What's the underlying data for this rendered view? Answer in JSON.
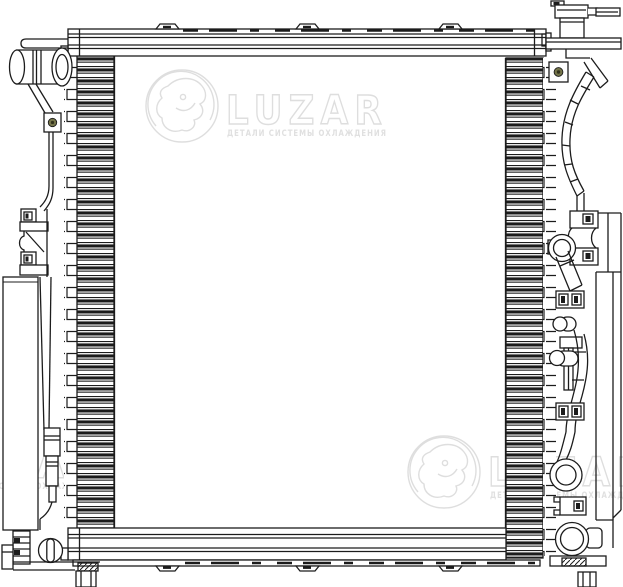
{
  "diagram": {
    "type": "technical-line-drawing",
    "subject": "automotive-radiator-front-view"
  },
  "watermark": {
    "brand": "LUZAR",
    "tagline": "ДЕТАЛИ СИСТЕМЫ ОХЛАЖДЕНИЯ",
    "instances": [
      "top-center",
      "bottom-left-partial",
      "bottom-right"
    ]
  },
  "colors": {
    "background": "#ffffff",
    "line": "#1c1c1c",
    "watermark_outline": "#dedede",
    "watermark_text": "#e0e0e0",
    "bolt": "#75754a"
  }
}
